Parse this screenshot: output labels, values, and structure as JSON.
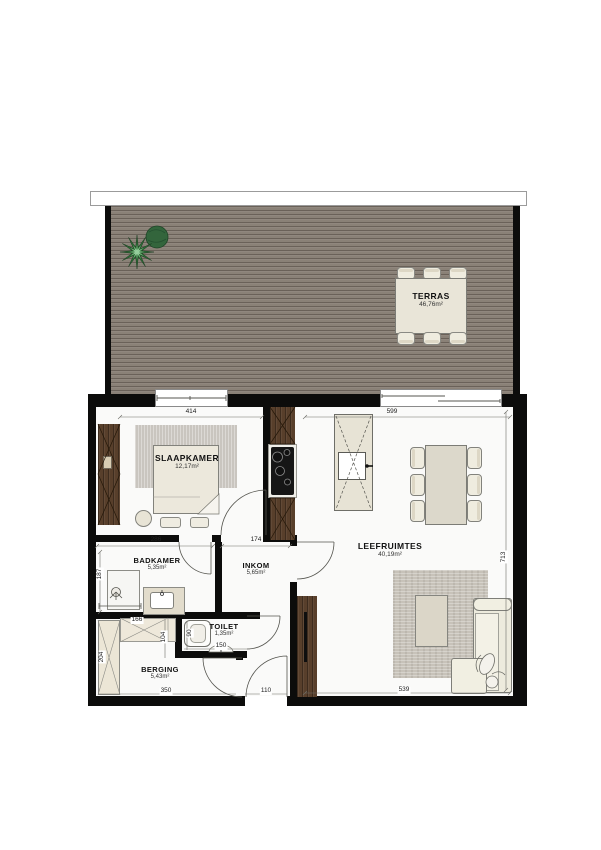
{
  "plan": {
    "rooms": {
      "terras": {
        "name": "TERRAS",
        "area": "46,76m²"
      },
      "slaapkamer": {
        "name": "SLAAPKAMER",
        "area": "12,17m²"
      },
      "badkamer": {
        "name": "BADKAMER",
        "area": "5,35m²"
      },
      "inkom": {
        "name": "INKOM",
        "area": "5,65m²"
      },
      "toilet": {
        "name": "TOILET",
        "area": "1,35m²"
      },
      "berging": {
        "name": "BERGING",
        "area": "5,43m²"
      },
      "leefruimtes": {
        "name": "LEEFRUIMTES",
        "area": "40,19m²"
      }
    },
    "dimensions": {
      "slaapkamer_width": "414",
      "leefruimtes_width": "599",
      "badkamer_width": "286",
      "inkom_width": "174",
      "badkamer_depth": "187",
      "berging_shelf_width": "166",
      "berging_shelf_depth": "104",
      "berging_cabinet_depth": "204",
      "toilet_depth": "90",
      "toilet_width": "150",
      "berging_width": "350",
      "entry_door_width": "110",
      "leefruimtes_bottom_width": "539",
      "leefruimtes_depth": "713"
    },
    "colors": {
      "wall": "#0c0c0b",
      "deck_wood": "#8a8177",
      "cabinet_wood": "#583f2b",
      "floor": "#fafaf9",
      "plant_green": "#2d6a35"
    }
  }
}
